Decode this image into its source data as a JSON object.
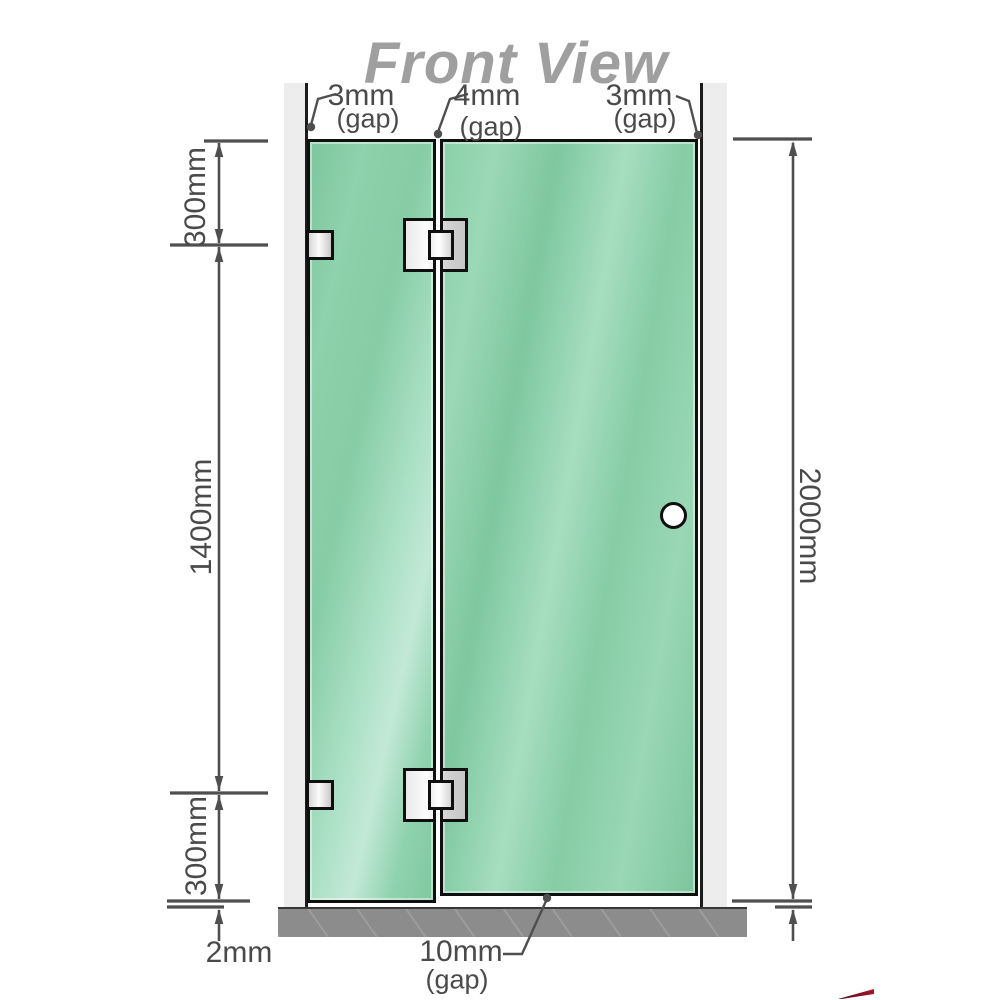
{
  "title": "Front View",
  "annotations": {
    "top_gaps": [
      {
        "value": "3mm",
        "qualifier": "(gap)"
      },
      {
        "value": "4mm",
        "qualifier": "(gap)"
      },
      {
        "value": "3mm",
        "qualifier": "(gap)"
      }
    ],
    "left_dimensions": {
      "top_segment": "300mm",
      "middle_segment": "1400mm",
      "bottom_segment": "300mm",
      "floor_gap": "2mm"
    },
    "right_dimension": {
      "total_height": "2000mm"
    },
    "bottom_gap": {
      "value": "10mm",
      "qualifier": "(gap)"
    }
  },
  "hardware": {
    "hinge_count": 2,
    "wall_bracket_count": 2,
    "handle_count": 1
  },
  "colors": {
    "glass_green": "#85cba4",
    "glass_highlight": "#c3e9d6",
    "wall_gray": "#ededed",
    "floor_gray": "#8c8c8c",
    "outline_black": "#0f0f0f",
    "dimension_gray": "#4f4f4f",
    "label_gray": "#4a4a4a",
    "title_gray": "#9f9f9f",
    "hardware_silver": "#e0e0e0",
    "accent_red": "#a8122d"
  }
}
